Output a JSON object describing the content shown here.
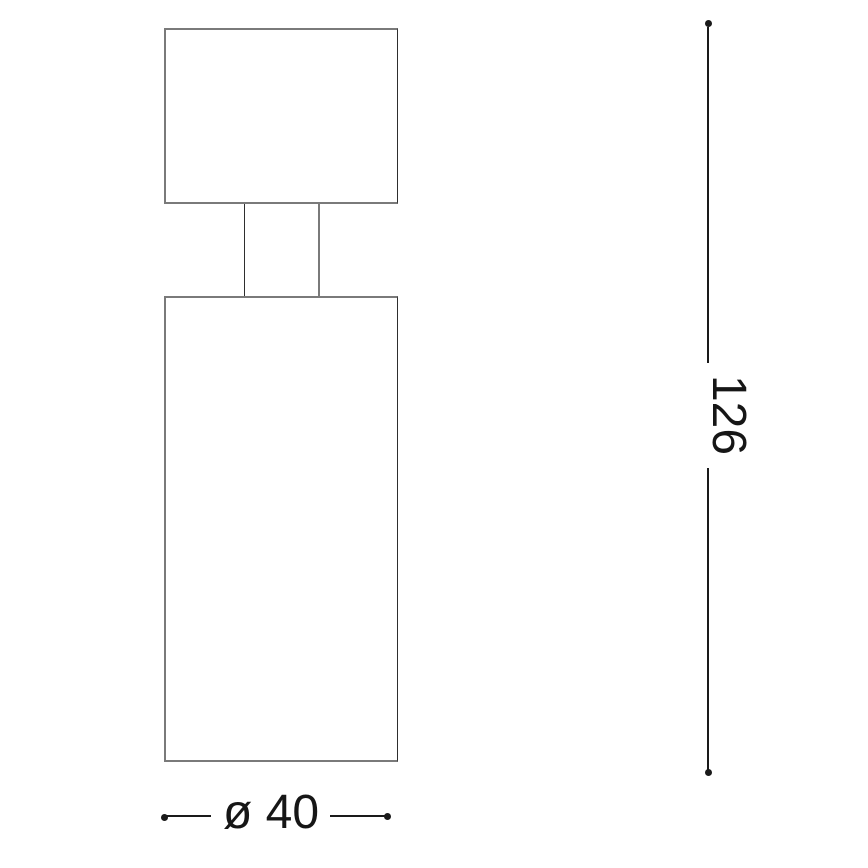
{
  "drawing": {
    "kind": "technical-dimension-drawing",
    "subject": "cylindrical-spotlight-side-view",
    "dimensions": {
      "height_label": "126",
      "height_value": 126,
      "diameter_label": "ø 40",
      "diameter_value": 40
    },
    "colors": {
      "outline_gray": "#7a7a7a",
      "dimension_black": "#1a1a1a",
      "background": "#ffffff"
    }
  }
}
